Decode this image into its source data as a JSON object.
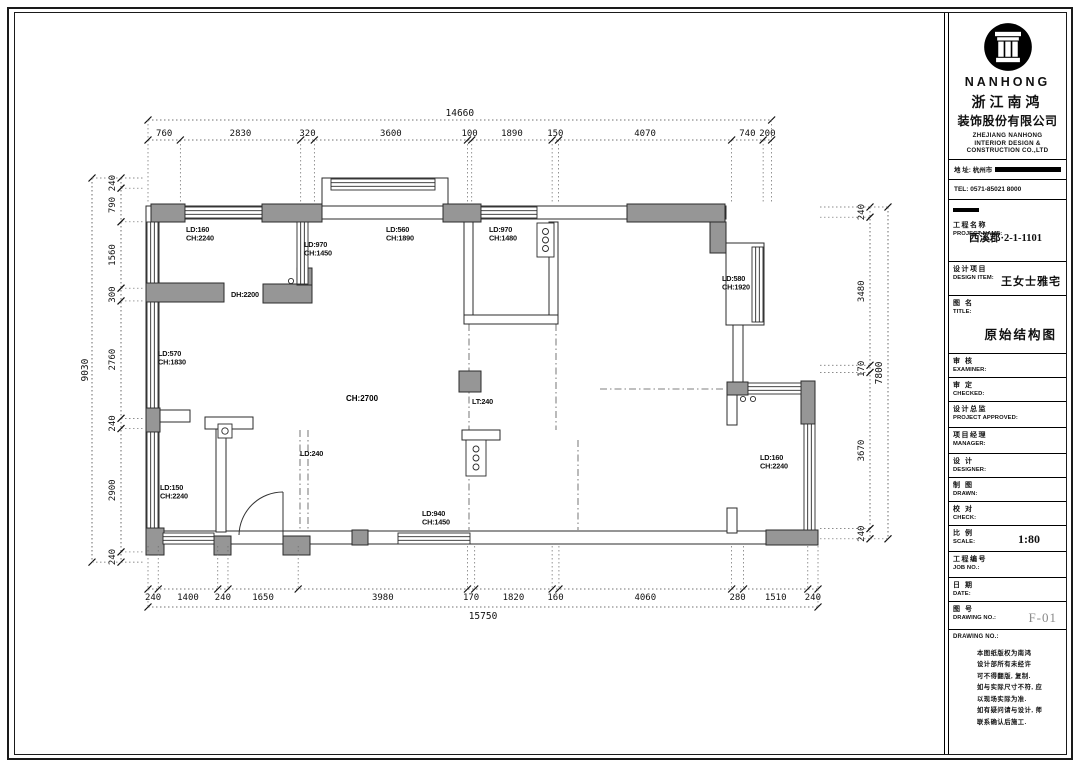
{
  "titleblock": {
    "brand": {
      "logo": "column-icon",
      "name": "NANHONG",
      "cn1": "浙江南鸿",
      "cn2": "装饰股份有限公司",
      "en1": "ZHEJIANG NANHONG",
      "en2": "INTERIOR DESIGN &",
      "en3": "CONSTRUCTION CO.,LTD"
    },
    "contact": {
      "address_label": "地 址: 杭州市",
      "tel": "TEL: 0571-85021 8000"
    },
    "rows": [
      {
        "cn": "工程名称",
        "en": "PROJECT NAME:",
        "value": "西溪郡·2-1-1101",
        "vc": "vc-center",
        "h": 62,
        "bar": true
      },
      {
        "cn": "设计项目",
        "en": "DESIGN ITEM:",
        "value": "王女士雅宅",
        "vc": "vc-inline",
        "h": 34
      },
      {
        "cn": "图  名",
        "en": "TITLE:",
        "value": "原始结构图",
        "vc": "vc-title",
        "h": 58
      },
      {
        "cn": "审  核",
        "en": "EXAMINER:",
        "value": "",
        "vc": "",
        "h": 24
      },
      {
        "cn": "审  定",
        "en": "CHECKED:",
        "value": "",
        "vc": "",
        "h": 24
      },
      {
        "cn": "设计总监",
        "en": "PROJECT APPROVED:",
        "value": "",
        "vc": "",
        "h": 26
      },
      {
        "cn": "项目经理",
        "en": "MANAGER:",
        "value": "",
        "vc": "",
        "h": 26
      },
      {
        "cn": "设  计",
        "en": "DESIGNER:",
        "value": "",
        "vc": "",
        "h": 24
      },
      {
        "cn": "制  图",
        "en": "DRAWN:",
        "value": "",
        "vc": "",
        "h": 24
      },
      {
        "cn": "校  对",
        "en": "CHECK:",
        "value": "",
        "vc": "",
        "h": 24
      },
      {
        "cn": "比  例",
        "en": "SCALE:",
        "value": "1:80",
        "vc": "vc-scale",
        "h": 26
      },
      {
        "cn": "工程编号",
        "en": "JOB  NO.:",
        "value": "",
        "vc": "",
        "h": 26
      },
      {
        "cn": "日  期",
        "en": "DATE:",
        "value": "",
        "vc": "",
        "h": 24
      },
      {
        "cn": "图  号",
        "en": "DRAWING NO.:",
        "value": "F-01",
        "vc": "vc-fno",
        "h": 28
      }
    ],
    "notes_label": "DRAWING NO.:",
    "notes": [
      "本图纸版权为南鸿",
      "设计部所有未经许",
      "可不得翻版, 复制.",
      "如与实际尺寸不符, 应",
      "以现场实际为准.",
      "如有疑问请与设计, 师",
      "联系确认后施工."
    ]
  },
  "plan": {
    "gray_walls": [
      [
        151,
        204,
        34,
        18
      ],
      [
        262,
        204,
        60,
        18
      ],
      [
        443,
        204,
        38,
        18
      ],
      [
        627,
        204,
        98,
        18
      ],
      [
        710,
        222,
        16,
        31
      ],
      [
        146,
        283,
        78,
        19
      ],
      [
        263,
        284,
        49,
        19
      ],
      [
        297,
        268,
        15,
        17
      ],
      [
        146,
        408,
        14,
        24
      ],
      [
        459,
        371,
        22,
        21
      ],
      [
        727,
        382,
        21,
        13
      ],
      [
        801,
        381,
        14,
        43
      ],
      [
        766,
        530,
        52,
        15
      ],
      [
        283,
        536,
        27,
        19
      ],
      [
        214,
        536,
        17,
        19
      ],
      [
        352,
        530,
        16,
        15
      ],
      [
        146,
        528,
        18,
        27
      ]
    ],
    "thin_walls": [
      [
        148,
        206,
        578,
        13
      ],
      [
        146,
        206,
        13,
        327
      ],
      [
        146,
        531,
        672,
        13
      ],
      [
        322,
        178,
        126,
        28
      ],
      [
        726,
        243,
        38,
        82
      ],
      [
        464,
        222,
        9,
        100
      ],
      [
        549,
        222,
        9,
        100
      ],
      [
        464,
        315,
        94,
        9
      ],
      [
        733,
        325,
        10,
        60
      ],
      [
        727,
        395,
        10,
        30
      ],
      [
        727,
        508,
        10,
        25
      ],
      [
        216,
        424,
        10,
        108
      ],
      [
        205,
        417,
        48,
        12
      ],
      [
        158,
        410,
        32,
        12
      ],
      [
        462,
        430,
        38,
        10
      ]
    ],
    "windows": [
      {
        "x": 185,
        "y": 207,
        "w": 77,
        "h": 11,
        "o": "h"
      },
      {
        "x": 481,
        "y": 207,
        "w": 56,
        "h": 11,
        "o": "h"
      },
      {
        "x": 331,
        "y": 179,
        "w": 104,
        "h": 11,
        "o": "h"
      },
      {
        "x": 147,
        "y": 222,
        "w": 11,
        "h": 61,
        "o": "v"
      },
      {
        "x": 147,
        "y": 302,
        "w": 11,
        "h": 106,
        "o": "v"
      },
      {
        "x": 147,
        "y": 432,
        "w": 11,
        "h": 96,
        "o": "v"
      },
      {
        "x": 752,
        "y": 247,
        "w": 11,
        "h": 75,
        "o": "v"
      },
      {
        "x": 748,
        "y": 383,
        "w": 53,
        "h": 11,
        "o": "h"
      },
      {
        "x": 804,
        "y": 424,
        "w": 11,
        "h": 106,
        "o": "v"
      },
      {
        "x": 163,
        "y": 533,
        "w": 51,
        "h": 11,
        "o": "h"
      },
      {
        "x": 398,
        "y": 533,
        "w": 72,
        "h": 11,
        "o": "h"
      },
      {
        "x": 297,
        "y": 222,
        "w": 11,
        "h": 62,
        "o": "v"
      }
    ],
    "boxes": [
      {
        "x": 537,
        "y": 223,
        "w": 17,
        "h": 34,
        "circles": 3
      },
      {
        "x": 466,
        "y": 440,
        "w": 20,
        "h": 36,
        "circles": 3
      },
      {
        "x": 218,
        "y": 424,
        "w": 14,
        "h": 14,
        "circles": 1
      }
    ],
    "circles": [
      [
        743,
        399
      ],
      [
        753,
        399
      ],
      [
        291,
        281
      ]
    ],
    "dashes": [
      [
        469,
        324,
        469,
        530
      ],
      [
        556,
        324,
        556,
        430
      ],
      [
        578,
        440,
        578,
        530
      ],
      [
        300,
        430,
        300,
        534
      ],
      [
        308,
        430,
        308,
        534
      ],
      [
        600,
        389,
        724,
        389
      ]
    ],
    "doors": [
      {
        "path": "M 283 492 A 44 44 0 0 0 239 535",
        "leaf": [
          283,
          536,
          283,
          492
        ],
        "mask": [
          240,
          532,
          42,
          11
        ]
      }
    ],
    "annotations": [
      {
        "lines": [
          "LD:160",
          "CH:2240"
        ],
        "x": 186,
        "y": 232
      },
      {
        "lines": [
          "LD:970",
          "CH:1450"
        ],
        "x": 304,
        "y": 247
      },
      {
        "lines": [
          "LD:560",
          "CH:1890"
        ],
        "x": 386,
        "y": 232
      },
      {
        "lines": [
          "LD:970",
          "CH:1480"
        ],
        "x": 489,
        "y": 232
      },
      {
        "lines": [
          "DH:2200"
        ],
        "x": 231,
        "y": 297
      },
      {
        "lines": [
          "LD:580",
          "CH:1920"
        ],
        "x": 722,
        "y": 281
      },
      {
        "lines": [
          "LD:570",
          "CH:1830"
        ],
        "x": 158,
        "y": 356
      },
      {
        "lines": [
          "CH:2700"
        ],
        "x": 346,
        "y": 401,
        "strong": true
      },
      {
        "lines": [
          "LT:240"
        ],
        "x": 472,
        "y": 404
      },
      {
        "lines": [
          "LD:240"
        ],
        "x": 300,
        "y": 456
      },
      {
        "lines": [
          "LD:150",
          "CH:2240"
        ],
        "x": 160,
        "y": 490
      },
      {
        "lines": [
          "LD:940",
          "CH:1450"
        ],
        "x": 422,
        "y": 516
      },
      {
        "lines": [
          "LD:160",
          "CH:2240"
        ],
        "x": 760,
        "y": 460
      }
    ],
    "dims": {
      "px_per_mm": 0.04254,
      "chains": [
        {
          "name": "top",
          "axis": "x",
          "origin": 148,
          "line": 140,
          "label_off": -4,
          "total_line": 120,
          "total_label_off": -4,
          "ext": [
            140,
            203
          ],
          "segments": [
            760,
            2830,
            320,
            3600,
            100,
            1890,
            150,
            4070,
            740,
            200
          ],
          "total": 14660
        },
        {
          "name": "bottom",
          "axis": "x",
          "origin": 148,
          "line": 589,
          "label_off": 11,
          "total_line": 607,
          "total_label_off": 12,
          "ext": [
            546,
            589
          ],
          "segments": [
            240,
            1400,
            240,
            1650,
            3980,
            170,
            1820,
            160,
            4060,
            280,
            1510,
            240
          ],
          "total": 15750
        },
        {
          "name": "left",
          "axis": "y",
          "origin": 178,
          "line": 121,
          "label_off": -6,
          "total_line": 92,
          "total_label_off": -4,
          "ext": [
            121,
            144
          ],
          "segments": [
            240,
            790,
            1560,
            300,
            2760,
            240,
            2900,
            240
          ],
          "total": 9030
        },
        {
          "name": "right",
          "axis": "y",
          "origin": 207,
          "line": 870,
          "label_off": -6,
          "total_line": 888,
          "total_label_off": -6,
          "ext": [
            820,
            870
          ],
          "segments": [
            240,
            3480,
            170,
            3670,
            240
          ],
          "total": 7800
        }
      ]
    }
  }
}
